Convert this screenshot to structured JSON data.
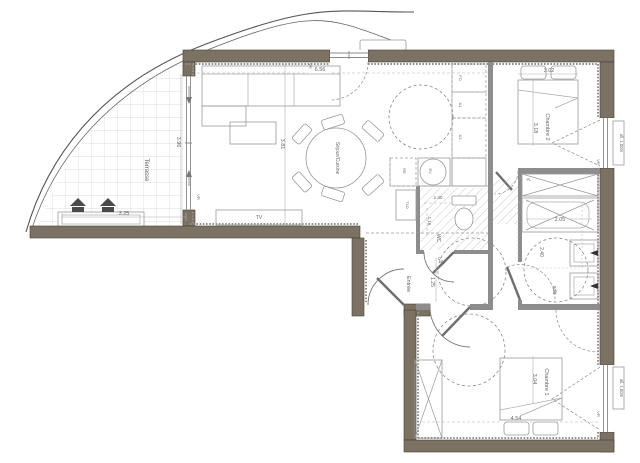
{
  "title": "Plan d'appartement",
  "rooms": {
    "terrasse": {
      "name": "Terrasse",
      "width_m": "3.25",
      "depth_m": "3.96"
    },
    "sejour_cuisine": {
      "name": "Séjour/Cuisine",
      "width_m": "6.56",
      "depth_m": "3.81"
    },
    "chambre2": {
      "name": "Chambre 2",
      "width_m": "3.02",
      "depth_m": "3.18"
    },
    "chambre1": {
      "name": "Chambre 1",
      "width_m": "4.54",
      "depth_m": "3.04"
    },
    "entree": {
      "name": "Entrée",
      "width_m": "1.25"
    },
    "wc": {
      "name": "WC",
      "width_m": "1.30",
      "depth_m": "1.16",
      "door_m": "0.94"
    },
    "sdb": {
      "name": "sdb",
      "tub_m": "2.05",
      "turning_m": "2.40"
    }
  },
  "fixtures": {
    "tv": "TV",
    "placard": "PL",
    "tld": "TLD",
    "four": "FO",
    "a1": "A1",
    "a3": "A3",
    "refrigerateur": "RE",
    "evier": "EV"
  },
  "windows": {
    "vr": "VR",
    "allege": "all. 1.00m"
  },
  "colors": {
    "wall": "#7b7264",
    "wall_edge": "#46402f",
    "partition": "#8d8d8d",
    "line": "#8a8a8a",
    "text": "#666666",
    "hatch": "#b8b8b8",
    "grid": "#d4d4d4"
  }
}
